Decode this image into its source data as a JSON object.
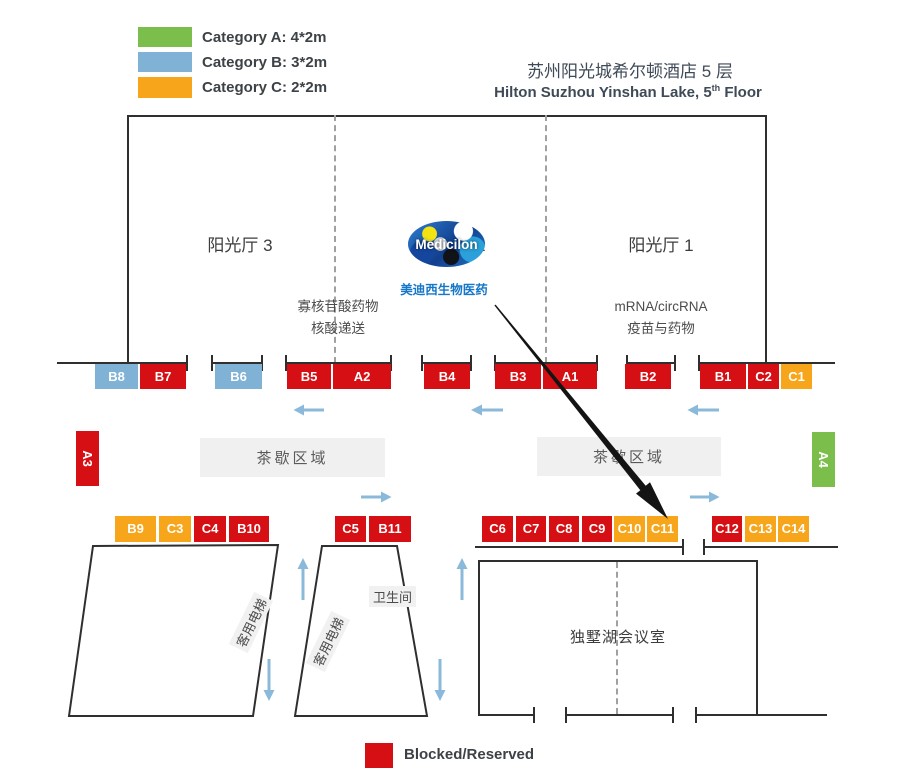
{
  "legend": {
    "items": [
      {
        "label": "Category A: 4*2m",
        "color": "#7cbe4b"
      },
      {
        "label": "Category B: 3*2m",
        "color": "#7fb2d5"
      },
      {
        "label": "Category C: 2*2m",
        "color": "#f7a51b"
      }
    ]
  },
  "venue": {
    "title_cn": "苏州阳光城希尔顿酒店 5 层",
    "title_en_main": "Hilton Suzhou Yinshan Lake, 5",
    "title_en_sup": "th",
    "title_en_tail": " Floor"
  },
  "halls": [
    {
      "name": "阳光厅 3"
    },
    {
      "name": "阳光厅 2"
    },
    {
      "name": "阳光厅 1"
    }
  ],
  "topics": {
    "left_line1": "寡核苷酸药物",
    "left_line2": "核酸递送",
    "right_line1": "mRNA/circRNA",
    "right_line2": "疫苗与药物"
  },
  "logo": {
    "text": "Medicilon",
    "caption": "美迪西生物医药"
  },
  "booths": {
    "row1": [
      {
        "id": "B8",
        "color": "blue"
      },
      {
        "id": "B7",
        "color": "red"
      },
      {
        "id": "B6",
        "color": "blue"
      },
      {
        "id": "B5",
        "color": "red"
      },
      {
        "id": "A2",
        "color": "red"
      },
      {
        "id": "B4",
        "color": "red"
      },
      {
        "id": "B3",
        "color": "red"
      },
      {
        "id": "A1",
        "color": "red"
      },
      {
        "id": "B2",
        "color": "red"
      },
      {
        "id": "B1",
        "color": "red"
      },
      {
        "id": "C2",
        "color": "red"
      },
      {
        "id": "C1",
        "color": "orange"
      }
    ],
    "row2": [
      {
        "id": "B9",
        "color": "orange"
      },
      {
        "id": "C3",
        "color": "orange"
      },
      {
        "id": "C4",
        "color": "red"
      },
      {
        "id": "B10",
        "color": "red"
      },
      {
        "id": "C5",
        "color": "red"
      },
      {
        "id": "B11",
        "color": "red"
      },
      {
        "id": "C6",
        "color": "red"
      },
      {
        "id": "C7",
        "color": "red"
      },
      {
        "id": "C8",
        "color": "red"
      },
      {
        "id": "C9",
        "color": "red"
      },
      {
        "id": "C10",
        "color": "orange"
      },
      {
        "id": "C11",
        "color": "orange"
      },
      {
        "id": "C12",
        "color": "red"
      },
      {
        "id": "C13",
        "color": "orange"
      },
      {
        "id": "C14",
        "color": "orange"
      }
    ],
    "side": [
      {
        "id": "A3",
        "color": "red"
      },
      {
        "id": "A4",
        "color": "green"
      }
    ]
  },
  "areas": {
    "tea1": "茶歇区域",
    "tea2": "茶歇区域",
    "restroom": "卫生间",
    "elevator1": "客用电梯",
    "elevator2": "客用电梯",
    "meeting_room": "独墅湖会议室"
  },
  "footer": {
    "blocked_label": "Blocked/Reserved",
    "blocked_color": "#d50f14"
  }
}
